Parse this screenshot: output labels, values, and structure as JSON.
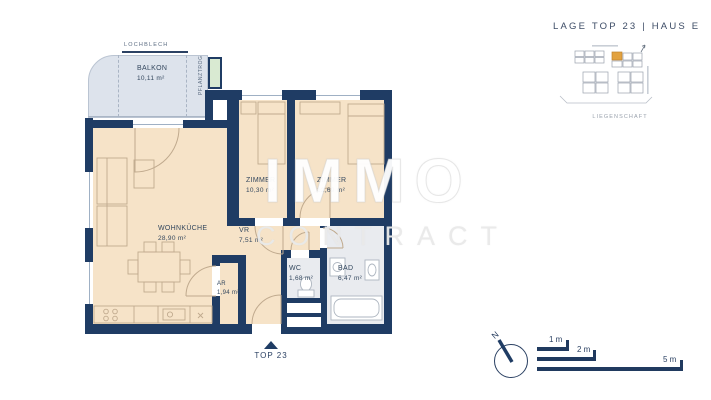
{
  "header": {
    "title": "LAGE TOP 23  |  HAUS E"
  },
  "watermark": {
    "line1": "IMMO",
    "line2": "CONTRACT"
  },
  "floor_plan": {
    "balcony": {
      "name": "BALKON",
      "area": "10,11 m²"
    },
    "lochblech_label": "LOCHBLECH",
    "pflanztrog_label": "PFLANZTROG",
    "rooms": {
      "wohnkueche": {
        "name": "WOHNKÜCHE",
        "area": "28,90 m²"
      },
      "zimmer1": {
        "name": "ZIMMER",
        "area": "10,30 m²"
      },
      "zimmer2": {
        "name": "ZIMMER",
        "area": "12,69 m²"
      },
      "vr": {
        "name": "VR",
        "area": "7,51 m²"
      },
      "wc": {
        "name": "WC",
        "area": "1,68 m²"
      },
      "bad": {
        "name": "BAD",
        "area": "6,47 m²"
      },
      "ar": {
        "name": "AR",
        "area": "1,94 m²"
      }
    },
    "entrance_label": "TOP 23"
  },
  "site_plan": {
    "caption": "LIEGENSCHAFT",
    "highlight_color": "#e2a23f"
  },
  "compass": {
    "north_label": "N"
  },
  "scale_bar": {
    "bars": [
      {
        "label": "1 m"
      },
      {
        "label": "2 m"
      },
      {
        "label": "5 m"
      }
    ]
  },
  "colors": {
    "wall": "#1f3c64",
    "room_fill": "#f6e3c8",
    "balcony_fill": "#dde3ec",
    "wet_room_fill": "#e9ebef",
    "planter_fill": "#d9ead2",
    "text": "#33475e"
  }
}
